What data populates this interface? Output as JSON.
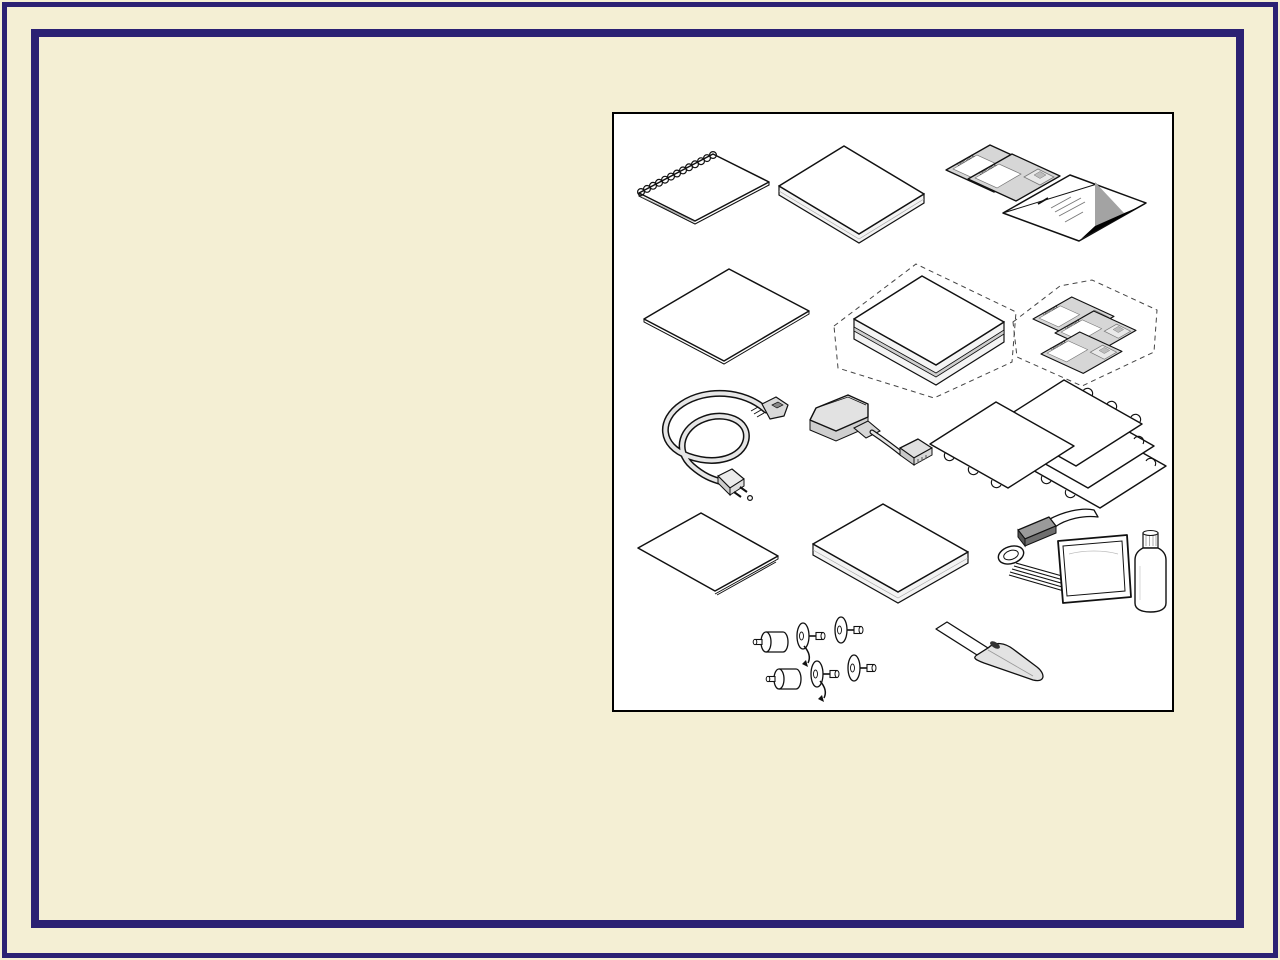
{
  "page": {
    "background_color": "#f4efd4",
    "frame_color": "#2b2173",
    "panel": {
      "background_color": "#ffffff",
      "border_color": "#000000"
    }
  },
  "labels": {
    "floppy_brand": "Lexmark"
  },
  "illustration": {
    "items": [
      {
        "name": "spiral-bound-manual"
      },
      {
        "name": "boxed-documentation"
      },
      {
        "name": "floppy-disk-pair"
      },
      {
        "name": "setup-card-with-triangle-logo"
      },
      {
        "name": "plain-sheet"
      },
      {
        "name": "optional-box-dashed-outline"
      },
      {
        "name": "optional-floppy-disks-dashed-outline"
      },
      {
        "name": "power-cord"
      },
      {
        "name": "parallel-port-adapter-cable"
      },
      {
        "name": "tractor-feed-label-sheets"
      },
      {
        "name": "folded-sheet"
      },
      {
        "name": "boxed-media"
      },
      {
        "name": "cleaning-kit"
      },
      {
        "name": "feed-roller-knobs"
      },
      {
        "name": "opener-knife"
      }
    ]
  }
}
